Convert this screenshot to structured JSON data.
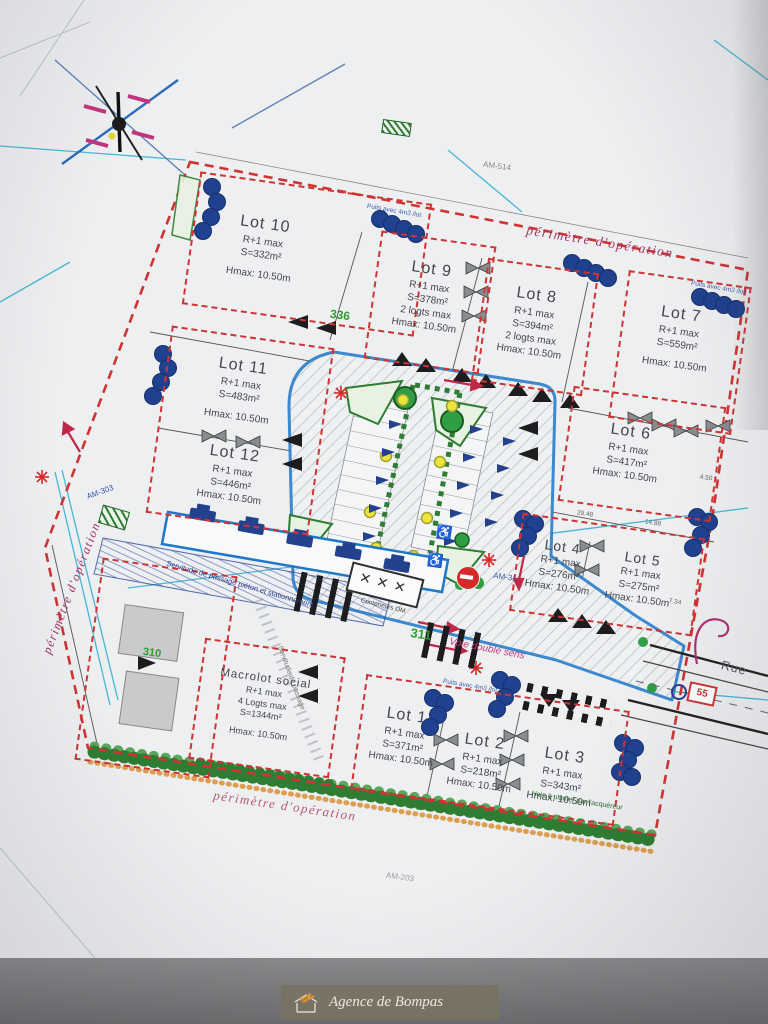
{
  "annotations": {
    "perimeter_label": "périmètre d'opération",
    "road_label": "Voie double sens",
    "street_label": "Rue",
    "servitude_label": "Servitude de passage piéton et stationnement",
    "servitude_path_label": "Servitude de passage",
    "container_label": "Conteneurs OM",
    "container_marks": "✕✕✕",
    "hedge_label": "Haie à planter par l'acquéreur",
    "puits_label": "Puits avec 4m3 /lot",
    "bus_sign": "55",
    "wheelchair": "♿",
    "refs": {
      "am514": "AM-514",
      "am31": "AM-31",
      "am303": "AM-303",
      "am203": "AM-203"
    },
    "numbers": {
      "n336": "336",
      "n311": "311",
      "n310": "310"
    },
    "dims": {
      "d1": "29.48",
      "d2": "14.88",
      "d3": "4.50",
      "d4": "7.34"
    }
  },
  "lots": [
    {
      "name": "Lot 10",
      "floors": "R+1 max",
      "surface": "S=332m²",
      "hmax": "Hmax: 10.50m"
    },
    {
      "name": "Lot 9",
      "floors": "R+1 max",
      "surface": "S=378m²",
      "logts": "2 logts max",
      "hmax": "Hmax: 10.50m"
    },
    {
      "name": "Lot 8",
      "floors": "R+1 max",
      "surface": "S=394m²",
      "logts": "2 logts max",
      "hmax": "Hmax: 10.50m"
    },
    {
      "name": "Lot 7",
      "floors": "R+1 max",
      "surface": "S=559m²",
      "hmax": "Hmax: 10.50m"
    },
    {
      "name": "Lot 11",
      "floors": "R+1 max",
      "surface": "S=483m²",
      "hmax": "Hmax: 10.50m"
    },
    {
      "name": "Lot 12",
      "floors": "R+1 max",
      "surface": "S=446m²",
      "hmax": "Hmax: 10.50m"
    },
    {
      "name": "Lot 6",
      "floors": "R+1 max",
      "surface": "S=417m²",
      "hmax": "Hmax: 10.50m"
    },
    {
      "name": "Lot 4",
      "floors": "R+1 max",
      "surface": "S=276m²",
      "hmax": "Hmax: 10.50m"
    },
    {
      "name": "Lot 5",
      "floors": "R+1 max",
      "surface": "S=275m²",
      "hmax": "Hmax: 10.50m"
    },
    {
      "name": "Macrolot social",
      "floors": "R+1 max",
      "logts": "4 Logts max",
      "surface": "S=1344m²",
      "hmax": "Hmax: 10.50m"
    },
    {
      "name": "Lot 1",
      "floors": "R+1 max",
      "surface": "S=371m²",
      "hmax": "Hmax: 10.50m"
    },
    {
      "name": "Lot 2",
      "floors": "R+1 max",
      "surface": "S=218m²",
      "hmax": "Hmax: 10.50m"
    },
    {
      "name": "Lot 3",
      "floors": "R+1 max",
      "surface": "S=343m²",
      "hmax": "Hmax: 10.50m"
    }
  ],
  "logo": {
    "name": "Agence de Bompas"
  },
  "colors": {
    "perimeter_red": "#cf3434",
    "road_blue": "#1e78c8",
    "deep_blue": "#24418e",
    "green": "#2e7d32",
    "magenta": "#b03a6e",
    "paper": "#edeff1"
  }
}
